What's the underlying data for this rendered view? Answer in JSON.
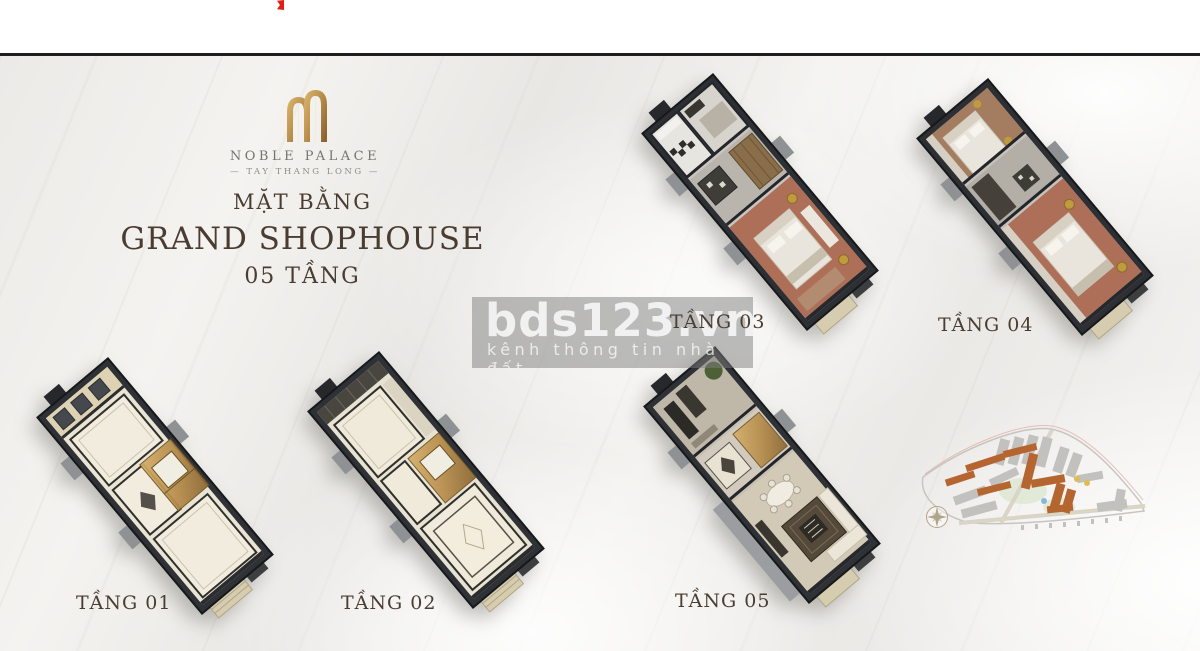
{
  "brand": {
    "name": "NOBLE PALACE",
    "tagline": "— TAY THANG LONG —",
    "logo_icon": "noble-palace-monogram",
    "gold_color": "#b68c4a"
  },
  "title": {
    "subtitle": "MẶT BẰNG",
    "main": "GRAND SHOPHOUSE",
    "floors_line": "05 TẦNG",
    "text_color": "#4a3c30"
  },
  "watermark": {
    "brand": "bds123.vn",
    "tagline": "kênh thông tin nhà đất",
    "background": "rgba(125,125,125,0.5)"
  },
  "floor_plans": [
    {
      "id": "tang-01",
      "label": "TẦNG 01"
    },
    {
      "id": "tang-02",
      "label": "TẦNG 02"
    },
    {
      "id": "tang-03",
      "label": "TẦNG 03"
    },
    {
      "id": "tang-04",
      "label": "TẦNG 04"
    },
    {
      "id": "tang-05",
      "label": "TẦNG 05"
    }
  ],
  "site_map": {
    "icon": "master-plan-map",
    "compass_icon": "compass-rose",
    "accent_color": "#b5652f"
  },
  "misc": {
    "red_mark_icon": "red-bookmark",
    "divider_color": "#1e1e1e"
  }
}
